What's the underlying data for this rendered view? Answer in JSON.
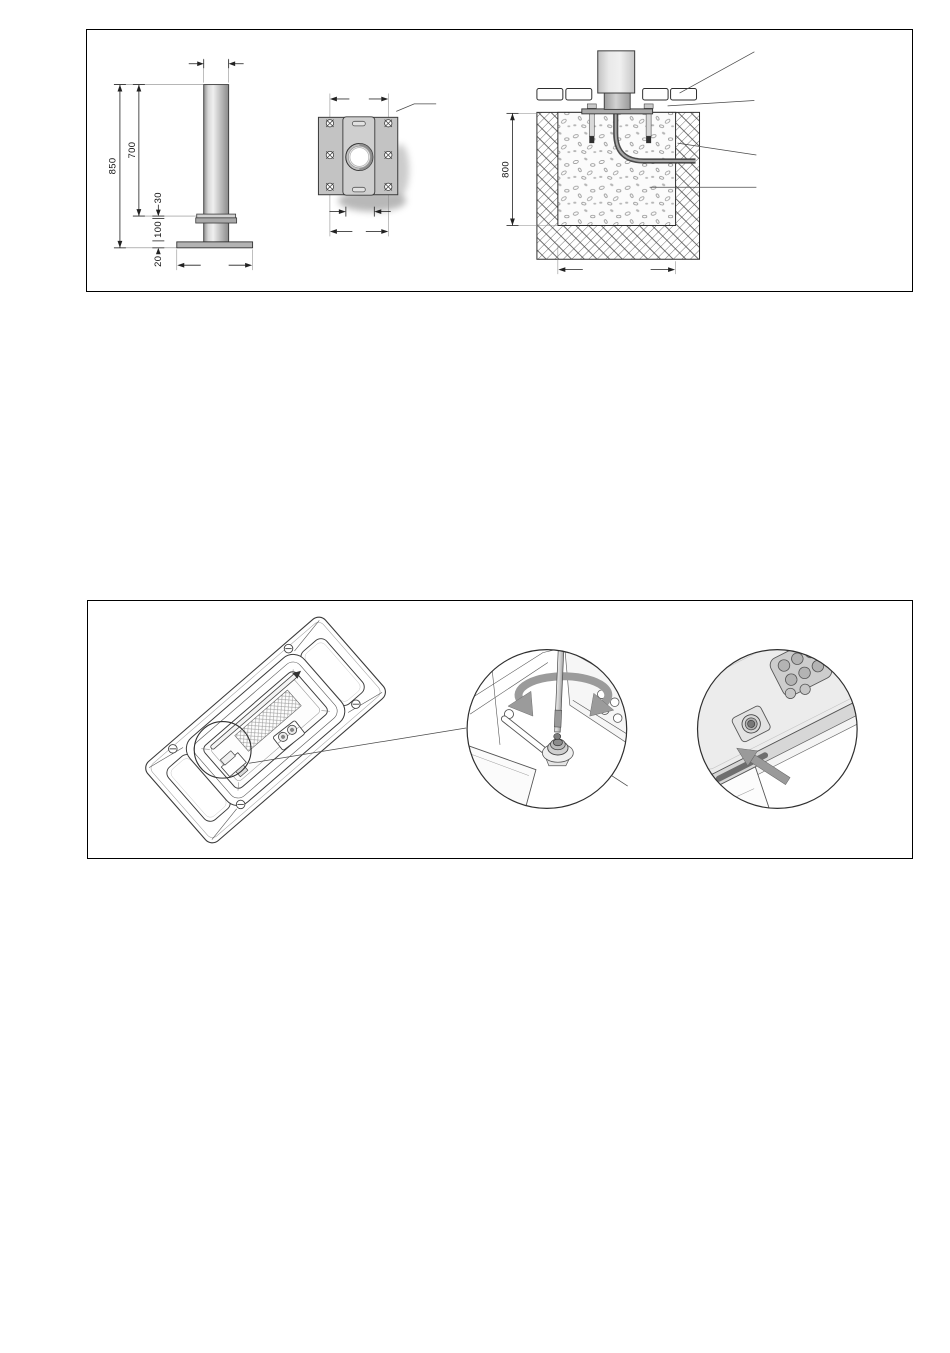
{
  "page": {
    "background": "#ffffff",
    "frame_border_color": "#000000"
  },
  "figure1": {
    "dimensions": {
      "overall_height": "850",
      "pole_height": "700",
      "collar_offset": "30",
      "base_section": "100",
      "plate_thickness": "20",
      "foundation_depth": "800"
    }
  },
  "colors": {
    "drawing_line": "#333333",
    "metal_light": "#e6e6e6",
    "metal_mid": "#b3b3b3",
    "rotation_arrow_gray": "#9b9b9b",
    "conduit_gray": "#4a4a4a"
  },
  "icons": {
    "detail_circle": "detail-circle",
    "hex_key": "hex-key-icon",
    "rotation_arrow": "rotation-arrow-icon",
    "slide_arrow": "slide-arrow-icon",
    "screw": "slotted-screw-icon"
  }
}
